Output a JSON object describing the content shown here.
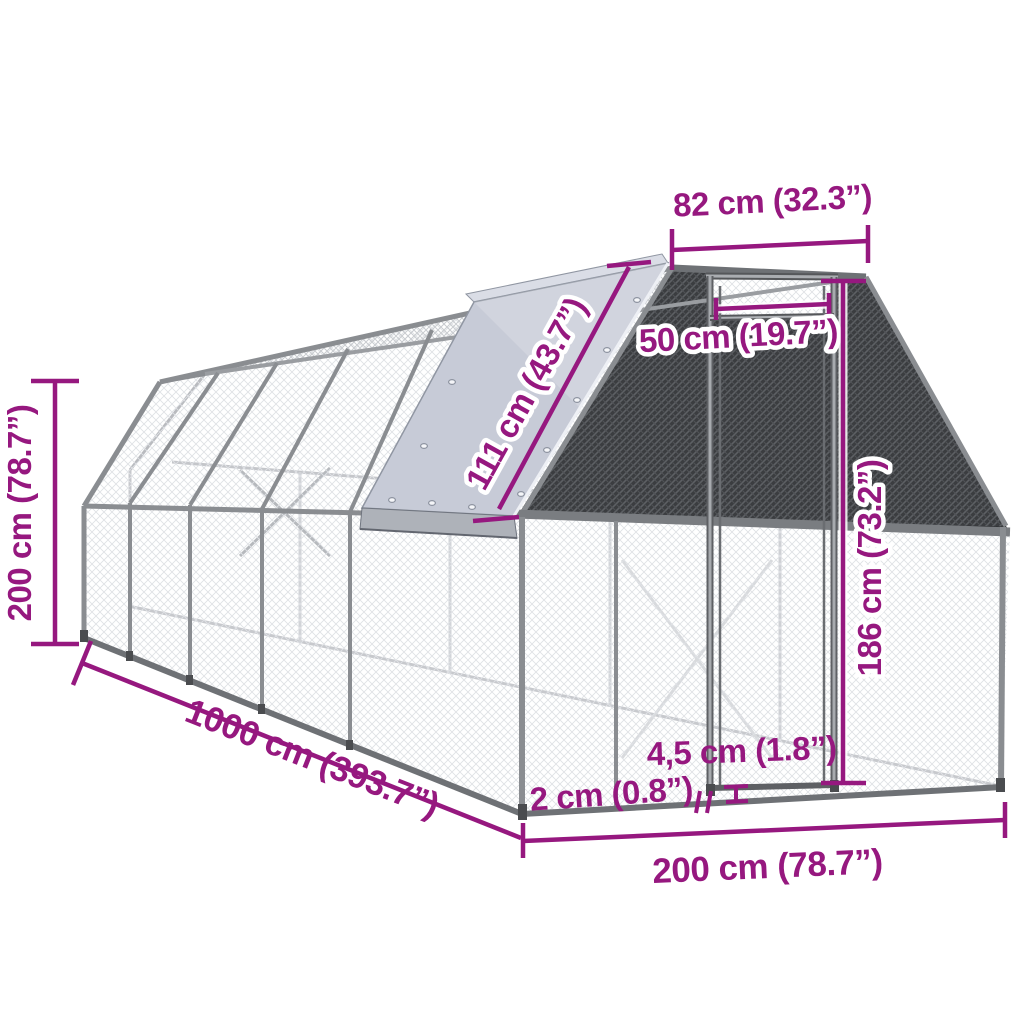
{
  "diagram": {
    "title": "outdoor-chicken-cage-dimension-diagram",
    "dimensions": {
      "top_width": "82 cm (32.3”)",
      "door_width": "50 cm (19.7”)",
      "roof_cover_length": "111 cm (43.7”)",
      "door_height": "186 cm (73.2”)",
      "height": "200 cm (78.7”)",
      "length": "1000 cm (393.7”)",
      "frame_bar": "4,5 cm (1.8”)",
      "mesh_wire": "2 cm (0.8”)",
      "width": "200 cm (78.7”)"
    },
    "colors": {
      "dimension_accent": "#96187F",
      "tarp": "#C7CBD7",
      "tarp_skirt": "#AEB2B9",
      "dark_mesh": "#3B3D40",
      "frame": "#8A8D91"
    }
  }
}
